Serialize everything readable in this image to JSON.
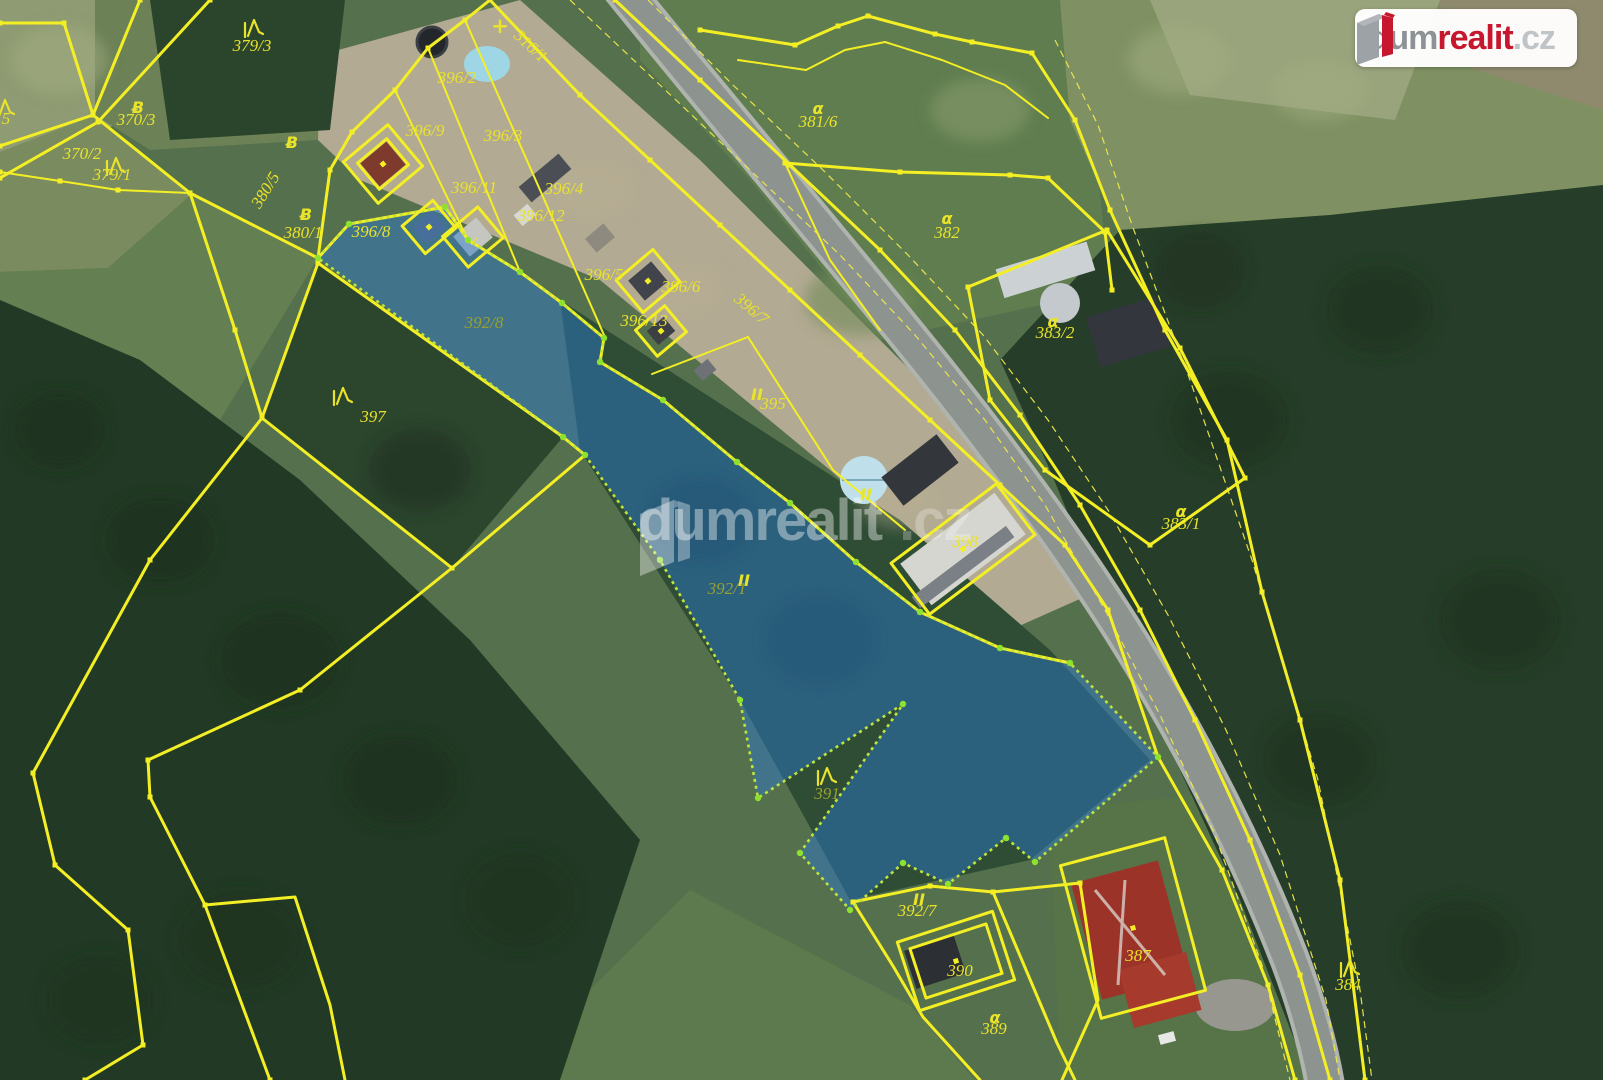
{
  "brand": {
    "dum": "dum",
    "realit": "realit",
    "tld": ".cz",
    "red": "#c6172e",
    "gray": "#8d9297",
    "lightgray": "#bfc4c8"
  },
  "watermark": {
    "text_main": "dumrealit",
    "text_tld": ".cz"
  },
  "map": {
    "colors": {
      "boundary_yellow": "#f4ef25",
      "highlight_fill_blue": "#2b7ad0",
      "highlight_stroke_lime": "#bfe43e",
      "label_yellow": "#e9e32b"
    },
    "highlight_parcel": {
      "label": "392/1",
      "points": "318,258 349,224 445,207 468,240 520,272 562,303 604,338 600,362 663,400 737,462 790,503 856,562 920,612 1000,648 1070,663 1158,757 1035,862 1006,838 948,884 903,863 850,910 800,853 903,704 758,798 740,700 660,560 585,455 563,437"
    },
    "parcel_labels": [
      {
        "id": "379-3",
        "text": "379/3",
        "x": 252,
        "y": 51
      },
      {
        "id": "370-3",
        "text": "370/3",
        "x": 136,
        "y": 125
      },
      {
        "id": "370-2",
        "text": "370/2",
        "x": 82,
        "y": 159
      },
      {
        "id": "379-1",
        "text": "379/1",
        "x": 112,
        "y": 180
      },
      {
        "id": "edge-partial-5",
        "text": "5",
        "x": 6,
        "y": 124
      },
      {
        "id": "380-5",
        "text": "380/5",
        "x": 270,
        "y": 193,
        "angle": -58
      },
      {
        "id": "380-1",
        "text": "380/1",
        "x": 303,
        "y": 238
      },
      {
        "id": "396-2",
        "text": "396/2",
        "x": 457,
        "y": 83
      },
      {
        "id": "396-9",
        "text": "396/9",
        "x": 425,
        "y": 136
      },
      {
        "id": "396-3",
        "text": "396/3",
        "x": 503,
        "y": 141
      },
      {
        "id": "396-11",
        "text": "396/11",
        "x": 474,
        "y": 193
      },
      {
        "id": "396-4",
        "text": "396/4",
        "x": 564,
        "y": 194
      },
      {
        "id": "396-12",
        "text": "396/12",
        "x": 541,
        "y": 221
      },
      {
        "id": "396-8",
        "text": "396/8",
        "x": 371,
        "y": 237
      },
      {
        "id": "316-1",
        "text": "316/1",
        "x": 527,
        "y": 50,
        "angle": 43
      },
      {
        "id": "381-6",
        "text": "381/6",
        "x": 818,
        "y": 127
      },
      {
        "id": "382",
        "text": "382",
        "x": 947,
        "y": 238
      },
      {
        "id": "383-2",
        "text": "383/2",
        "x": 1055,
        "y": 338
      },
      {
        "id": "383-1",
        "text": "383/1",
        "x": 1181,
        "y": 529
      },
      {
        "id": "396-5",
        "text": "396/5",
        "x": 604,
        "y": 280
      },
      {
        "id": "396-6",
        "text": "396/6",
        "x": 681,
        "y": 292
      },
      {
        "id": "396-13",
        "text": "396/13",
        "x": 644,
        "y": 326
      },
      {
        "id": "396-7",
        "text": "396/7",
        "x": 748,
        "y": 313,
        "angle": 40
      },
      {
        "id": "395",
        "text": "395",
        "x": 773,
        "y": 409
      },
      {
        "id": "398",
        "text": "398",
        "x": 965,
        "y": 547
      },
      {
        "id": "392-1",
        "text": "392/1",
        "x": 727,
        "y": 594,
        "dim": true
      },
      {
        "id": "392-8",
        "text": "392/8",
        "x": 484,
        "y": 328,
        "dim": true
      },
      {
        "id": "397",
        "text": "397",
        "x": 373,
        "y": 422
      },
      {
        "id": "391",
        "text": "391",
        "x": 827,
        "y": 799,
        "dim": true
      },
      {
        "id": "392-7",
        "text": "392/7",
        "x": 917,
        "y": 916
      },
      {
        "id": "390",
        "text": "390",
        "x": 960,
        "y": 976
      },
      {
        "id": "389",
        "text": "389",
        "x": 994,
        "y": 1034
      },
      {
        "id": "387",
        "text": "387",
        "x": 1138,
        "y": 961
      },
      {
        "id": "384",
        "text": "384",
        "x": 1348,
        "y": 990
      }
    ],
    "symbols": [
      {
        "type": "conifer",
        "x": 253,
        "y": 28
      },
      {
        "type": "conifer",
        "x": 115,
        "y": 166
      },
      {
        "type": "conifer",
        "x": 342,
        "y": 396
      },
      {
        "type": "conifer",
        "x": 826,
        "y": 776
      },
      {
        "type": "conifer",
        "x": 1349,
        "y": 968
      },
      {
        "type": "conifer",
        "x": 4,
        "y": 108
      },
      {
        "type": "grass",
        "x": 818,
        "y": 108
      },
      {
        "type": "grass",
        "x": 947,
        "y": 218
      },
      {
        "type": "grass",
        "x": 1053,
        "y": 321
      },
      {
        "type": "grass",
        "x": 1181,
        "y": 511
      },
      {
        "type": "grass",
        "x": 995,
        "y": 1017
      },
      {
        "type": "b-symbol",
        "x": 138,
        "y": 107
      },
      {
        "type": "b-symbol",
        "x": 292,
        "y": 142
      },
      {
        "type": "b-symbol",
        "x": 306,
        "y": 214
      },
      {
        "type": "ii-symbol",
        "x": 757,
        "y": 394
      },
      {
        "type": "ii-symbol",
        "x": 744,
        "y": 580
      },
      {
        "type": "ii-symbol",
        "x": 919,
        "y": 899
      },
      {
        "type": "ii-symbol",
        "x": 866,
        "y": 494
      },
      {
        "type": "plus-symbol",
        "x": 500,
        "y": 27
      },
      {
        "type": "check-symbol",
        "x": 474,
        "y": 240
      }
    ],
    "boundaries": [
      {
        "id": "nw-1",
        "style": "main",
        "dots": true,
        "points": "0,23 64,23 93,115"
      },
      {
        "id": "nw-2",
        "style": "main",
        "dots": true,
        "points": "140,0 93,115 0,146"
      },
      {
        "id": "nw-3",
        "style": "main",
        "dots": true,
        "points": "210,0 98,122 0,178"
      },
      {
        "id": "nw-4",
        "style": "main",
        "dots": true,
        "points": "93,115 190,193 318,258"
      },
      {
        "id": "nw-5",
        "style": "med",
        "dots": true,
        "points": "0,172 60,181 118,190 190,193"
      },
      {
        "id": "cluster-west",
        "style": "main",
        "dots": true,
        "points": "318,258 330,170 352,132 395,90 428,48 465,20 490,0"
      },
      {
        "id": "parcel-row-south",
        "style": "main",
        "dots": true,
        "points": "318,258 349,224 445,207 468,240 520,272 562,303 604,338 600,362 663,400 737,462 790,503 856,562 920,612 1000,648 1070,663"
      },
      {
        "id": "road-sw",
        "style": "main",
        "dots": true,
        "points": "490,0 580,95 650,160 720,225 790,290 860,355 930,420 1000,485 1065,545 1108,610 1158,757 1222,870 1268,985 1295,1080"
      },
      {
        "id": "road-ne",
        "style": "main",
        "dots": true,
        "points": "615,0 700,80 790,165 880,250 955,330 1020,415 1080,505 1140,610 1195,720 1250,840 1300,975 1330,1080"
      },
      {
        "id": "road-dash-1",
        "style": "thin",
        "points": "570,0 660,85 750,170 840,255 915,335 985,420 1045,505 1105,610 1160,715 1215,835 1262,965 1290,1080"
      },
      {
        "id": "road-dash-2",
        "style": "thin",
        "points": "648,0 733,85 823,170 908,255 983,335 1048,420 1108,510 1168,615 1226,730 1280,855 1326,1000 1340,1080"
      },
      {
        "id": "parcel-397",
        "style": "main",
        "dots": true,
        "points": "318,263 563,437 585,455 452,568 262,418 318,263"
      },
      {
        "id": "west-mid",
        "style": "main",
        "dots": true,
        "points": "190,193 235,330 262,418"
      },
      {
        "id": "sw-long-1",
        "style": "main",
        "dots": true,
        "points": "262,418 150,560 33,773 55,865 128,930 143,1045 85,1080"
      },
      {
        "id": "sw-long-2",
        "style": "main",
        "dots": true,
        "points": "452,568 300,690 148,760 150,797 205,905 270,1080"
      },
      {
        "id": "sw-branch",
        "style": "main",
        "dots": false,
        "points": "205,905 295,897 330,1005 345,1080"
      },
      {
        "id": "ne-top-1",
        "style": "main",
        "dots": true,
        "points": "700,30 795,45 838,26 868,16 935,34 972,42 1032,53"
      },
      {
        "id": "ne-top-2",
        "style": "med",
        "dots": false,
        "points": "738,60 806,70 845,50 885,42 942,60 1005,85 1048,118"
      },
      {
        "id": "parcel-382-n",
        "style": "main",
        "dots": true,
        "points": "785,163 900,172 1010,175 1048,178 1105,232 1112,290"
      },
      {
        "id": "parcel-382-w",
        "style": "med",
        "dots": false,
        "points": "785,163 830,260 880,330"
      },
      {
        "id": "parcel-383-2",
        "style": "main",
        "dots": true,
        "points": "968,287 1107,230 1180,348 1245,478 1150,545 1045,470 990,400 968,287"
      },
      {
        "id": "east-long",
        "style": "main",
        "dots": true,
        "points": "1032,53 1075,120 1110,210 1165,330 1227,440 1262,592 1300,720 1340,880 1365,1080"
      },
      {
        "id": "east-dash",
        "style": "thin",
        "points": "1055,40 1098,125 1132,225 1190,380 1252,560 1318,780 1360,990 1372,1080"
      },
      {
        "id": "div-396-a",
        "style": "med",
        "dots": false,
        "points": "395,90 468,240"
      },
      {
        "id": "div-396-b",
        "style": "med",
        "dots": false,
        "points": "428,48 520,272"
      },
      {
        "id": "div-396-c",
        "style": "med",
        "dots": false,
        "points": "465,20 604,335"
      },
      {
        "id": "parcel-395-nw",
        "style": "med",
        "dots": false,
        "points": "652,374 748,337"
      },
      {
        "id": "parcel-395-ne",
        "style": "med",
        "dots": false,
        "points": "748,337 833,470 905,530"
      },
      {
        "id": "se-1",
        "style": "main",
        "dots": true,
        "points": "853,902 930,886 993,892 1080,883"
      },
      {
        "id": "se-2",
        "style": "main",
        "dots": false,
        "points": "993,892 1057,1043 1075,1080"
      },
      {
        "id": "se-3",
        "style": "main",
        "dots": false,
        "points": "853,902 893,966 923,1017 980,1080"
      },
      {
        "id": "se-4",
        "style": "main",
        "dots": false,
        "points": "1080,883 1098,1000 1062,1080"
      }
    ],
    "buildings": [
      {
        "id": "house-396-9",
        "cx": 383,
        "cy": 164,
        "w": 58,
        "h": 54,
        "rot": -40,
        "double": true,
        "dot": true
      },
      {
        "id": "shed-396-11",
        "cx": 429,
        "cy": 227,
        "w": 40,
        "h": 36,
        "rot": -40,
        "dot": true
      },
      {
        "id": "shed-396-12",
        "cx": 473,
        "cy": 237,
        "w": 46,
        "h": 40,
        "rot": -40,
        "dot": false
      },
      {
        "id": "house-396-6",
        "cx": 648,
        "cy": 281,
        "w": 48,
        "h": 42,
        "rot": -40,
        "dot": true
      },
      {
        "id": "shed-396-13",
        "cx": 661,
        "cy": 331,
        "w": 38,
        "h": 34,
        "rot": -40,
        "dot": true
      },
      {
        "id": "building-398",
        "cx": 963,
        "cy": 549,
        "w": 132,
        "h": 64,
        "rot": -37,
        "dot": true
      },
      {
        "id": "house-390",
        "cx": 956,
        "cy": 961,
        "w": 100,
        "h": 72,
        "rot": -18,
        "double": true,
        "dot": true
      },
      {
        "id": "house-387",
        "cx": 1133,
        "cy": 928,
        "w": 108,
        "h": 158,
        "rot": -15,
        "dot": true
      }
    ]
  }
}
